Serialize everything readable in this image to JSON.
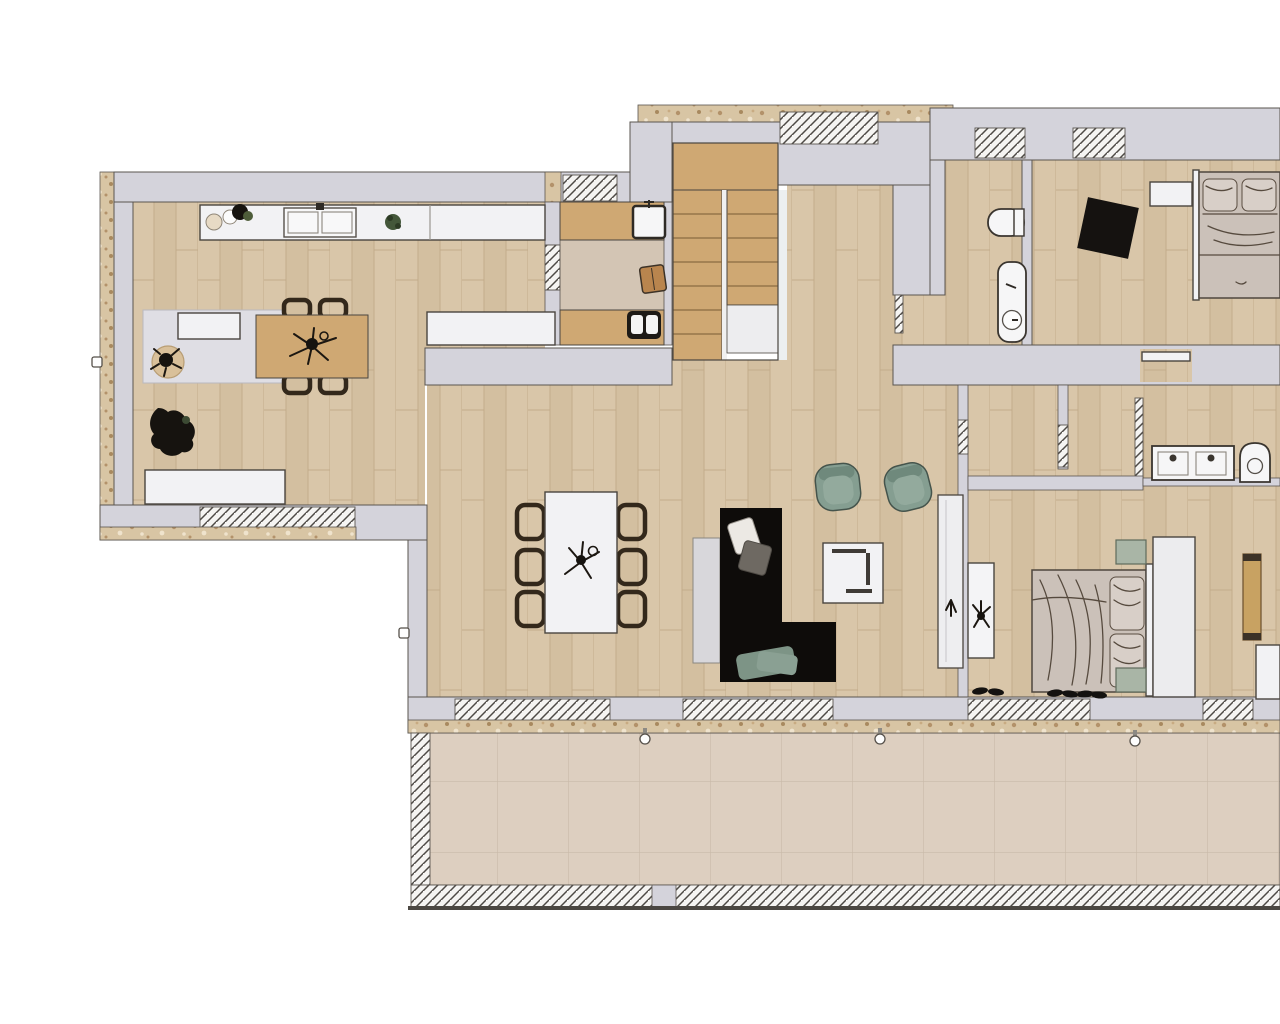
{
  "scene": {
    "type": "architectural-floor-plan",
    "style": "rendered 2d top-down plan, no text labels",
    "storey_rooms": [
      "kitchen-dining",
      "mudroom-laundry",
      "staircase",
      "entry-hall",
      "wc",
      "bedroom-top-right",
      "corridor",
      "bathroom-ensuite",
      "bedroom-master",
      "living-room",
      "terrace"
    ]
  },
  "colors": {
    "background": "#ffffff",
    "wall": "#d4d3db",
    "wall_edge": "#5a554f",
    "floor_wood": "#d9c6a9",
    "floor_wood_alt": "#d3bfa0",
    "wood_line": "#c3ac8b",
    "stair_wood": "#cfa873",
    "tread_line": "#8a6b42",
    "stone": "#d8c5a4",
    "stone_speck_dark": "#b3926a",
    "stone_speck_light": "#efe3cd",
    "tile": "#ddcfc0",
    "tile_line": "#c9baa9",
    "hatch_bg": "#f5f4f2",
    "hatch_line": "#4e4a46",
    "white_furniture": "#f2f2f4",
    "furniture_edge": "#4a453f",
    "landing_white": "#ededef",
    "sofa": "#0e0c0a",
    "sage": "#859e91",
    "sage_light": "#a9b5a6",
    "bed_duvet": "#cbc1b9",
    "bed_pillow": "#d8cfc8",
    "sketch": "#564a3e",
    "rug_black": "#151210",
    "rug_jute": "#d9c09a",
    "mat_gray": "#dfdee4",
    "dark_plant": "#16130f",
    "green_plant": "#44573a",
    "mud_floor": "#d3c5b4",
    "board_gray": "#d8d7db"
  },
  "furniture": {
    "kitchen": [
      "kitchen-counter-with-sink",
      "counter-plates",
      "counter-plants",
      "lower-counter",
      "pantry-mat",
      "pantry-sideboard",
      "jute-rug-with-plant",
      "floor-plant",
      "white-sideboard",
      "wood-dining-table",
      "four-wood-chairs"
    ],
    "mudroom": [
      "wood-bench-top",
      "wash-basin",
      "stool",
      "wood-bench-bottom",
      "washing-machine"
    ],
    "staircase": [
      "upper-landing",
      "left-flight",
      "right-flight",
      "mid-landing"
    ],
    "wc": [
      "toilet",
      "washbasin-column"
    ],
    "bedroom_top": [
      "double-bed",
      "headboard",
      "nightstand",
      "black-diamond-rug"
    ],
    "bathroom_ensuite": [
      "double-vanity",
      "toilet"
    ],
    "bedroom_master": [
      "double-bed",
      "headboard",
      "sage-nightstands",
      "wardrobe",
      "tall-mirror-with-plant",
      "wood-bench",
      "corner-shelf",
      "shoes"
    ],
    "living": [
      "white-dining-table",
      "six-dark-chairs",
      "table-centerpiece",
      "gray-floor-board",
      "black-l-shaped-sofa",
      "sofa-pillows",
      "two-sage-armchairs",
      "white-coffee-table",
      "tall-white-cabinet"
    ],
    "terrace": [
      "stone-tile-paving",
      "sliding-door-handles"
    ]
  }
}
